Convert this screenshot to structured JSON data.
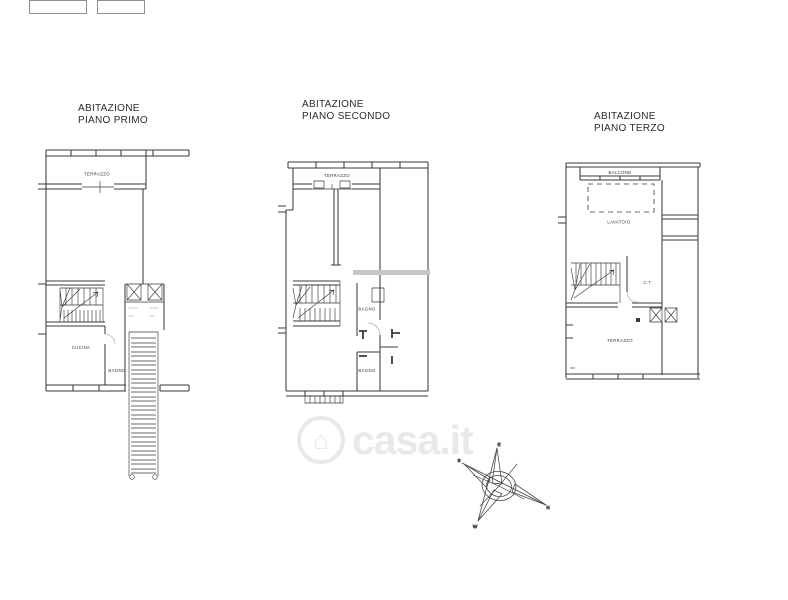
{
  "plans": [
    {
      "title": [
        "ABITAZIONE",
        "PIANO PRIMO"
      ],
      "labels": {
        "terrazzo": "TERRAZZO",
        "cucina": "CUCINA",
        "bagno": "BAGNO"
      }
    },
    {
      "title": [
        "ABITAZIONE",
        "PIANO SECONDO"
      ],
      "labels": {
        "terrazzo": "TERRAZZO",
        "bagno_1": "BAGNO",
        "bagno_2": "BAGNO"
      }
    },
    {
      "title": [
        "ABITAZIONE",
        "PIANO TERZO"
      ],
      "labels": {
        "balcone": "BALCONE",
        "lavatoio": "LAVATOIO",
        "ct": "C.T.",
        "terrazzo": "TERRAZZO"
      }
    }
  ],
  "watermark": {
    "brand": "casa.it",
    "icon": "house-circle-icon"
  },
  "compass": {
    "n": "N",
    "s": "S",
    "e": "E",
    "w": "W"
  },
  "drawing": {
    "ink": "#3a3a3a",
    "light_ink": "#9a9a9a",
    "slab_gray": "#c6c6c6",
    "watermark_gray": "#e9e9e9",
    "background": "#ffffff"
  }
}
